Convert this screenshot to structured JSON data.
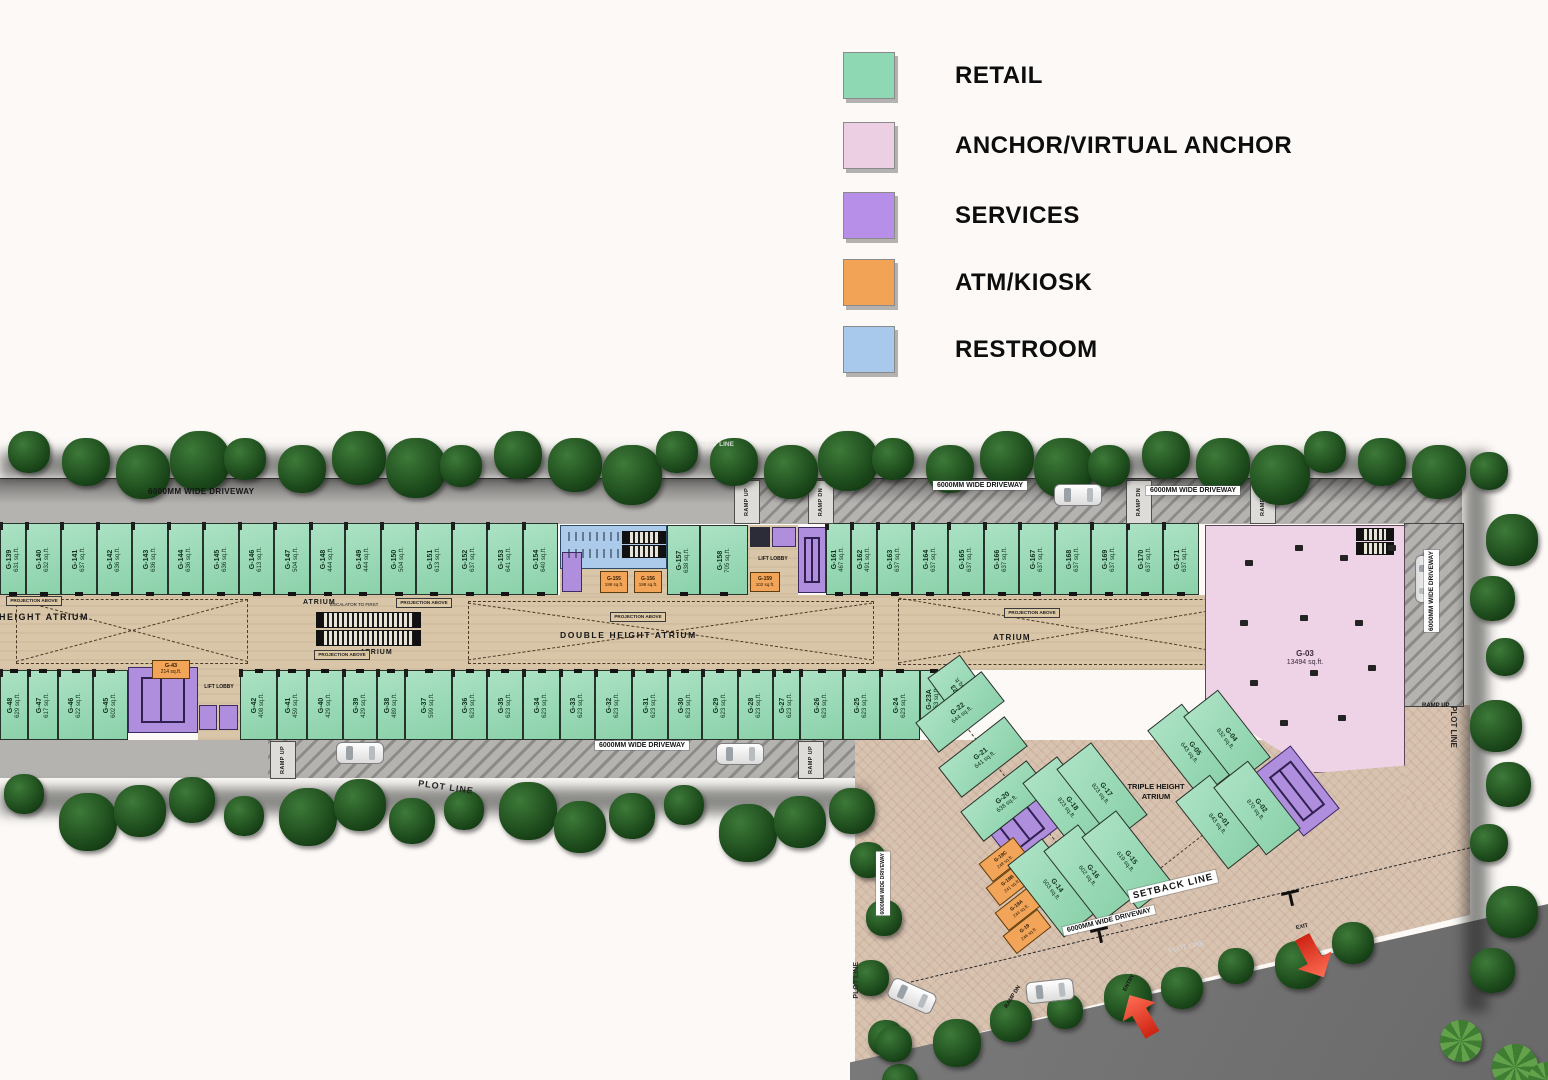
{
  "legend": {
    "items": [
      {
        "label": "RETAIL",
        "color": "#8fd8b4"
      },
      {
        "label": "ANCHOR/VIRTUAL ANCHOR",
        "color": "#eccfe3"
      },
      {
        "label": "SERVICES",
        "color": "#b78ee8"
      },
      {
        "label": "ATM/KIOSK",
        "color": "#f2a355"
      },
      {
        "label": "RESTROOM",
        "color": "#a8c8ec"
      }
    ]
  },
  "labels": {
    "driveway": "6000MM WIDE DRIVEWAY",
    "ramp_up": "RAMP UP",
    "ramp_dn": "RAMP DN",
    "plot_line": "PLOT LINE",
    "setback_line": "SETBACK LINE",
    "atrium": "ATRIUM",
    "double_atrium": "DOUBLE HEIGHT ATRIUM",
    "triple_atrium": "TRIPLE HEIGHT ATRIUM",
    "projection": "PROJECTION ABOVE",
    "escalator": "ESCALATOR TO FIRST",
    "lift_lobby": "LIFT LOBBY",
    "entry": "ENTRY",
    "exit": "EXIT"
  },
  "units": {
    "top_left": [
      {
        "id": "G-139",
        "area": "631 sq.ft.",
        "type": "retail"
      },
      {
        "id": "G-140",
        "area": "632 sq.ft.",
        "type": "retail"
      },
      {
        "id": "G-141",
        "area": "637 sq.ft.",
        "type": "retail"
      },
      {
        "id": "G-142",
        "area": "636 sq.ft.",
        "type": "retail"
      },
      {
        "id": "G-143",
        "area": "636 sq.ft.",
        "type": "retail"
      },
      {
        "id": "G-144",
        "area": "636 sq.ft.",
        "type": "retail"
      },
      {
        "id": "G-145",
        "area": "636 sq.ft.",
        "type": "retail"
      },
      {
        "id": "G-146",
        "area": "613 sq.ft.",
        "type": "retail"
      },
      {
        "id": "G-147",
        "area": "504 sq.ft.",
        "type": "retail"
      },
      {
        "id": "G-148",
        "area": "444 sq.ft.",
        "type": "retail"
      },
      {
        "id": "G-149",
        "area": "444 sq.ft.",
        "type": "retail"
      },
      {
        "id": "G-150",
        "area": "504 sq.ft.",
        "type": "retail"
      },
      {
        "id": "G-151",
        "area": "613 sq.ft.",
        "type": "retail"
      },
      {
        "id": "G-152",
        "area": "637 sq.ft.",
        "type": "retail"
      },
      {
        "id": "G-153",
        "area": "641 sq.ft.",
        "type": "retail"
      },
      {
        "id": "G-154",
        "area": "640 sq.ft.",
        "type": "retail"
      }
    ],
    "top_mid": [
      {
        "id": "G-155",
        "area": "199 sq.ft.",
        "type": "atm"
      },
      {
        "id": "G-156",
        "area": "198 sq.ft.",
        "type": "atm"
      },
      {
        "id": "G-157",
        "area": "638 sq.ft.",
        "type": "retail"
      },
      {
        "id": "G-158",
        "area": "705 sq.ft.",
        "type": "retail"
      },
      {
        "id": "G-159",
        "area": "102 sq.ft.",
        "type": "atm"
      }
    ],
    "top_right": [
      {
        "id": "G-161",
        "area": "467 sq.ft.",
        "type": "retail"
      },
      {
        "id": "G-162",
        "area": "491 sq.ft.",
        "type": "retail"
      },
      {
        "id": "G-163",
        "area": "637 sq.ft.",
        "type": "retail"
      },
      {
        "id": "G-164",
        "area": "637 sq.ft.",
        "type": "retail"
      },
      {
        "id": "G-165",
        "area": "637 sq.ft.",
        "type": "retail"
      },
      {
        "id": "G-166",
        "area": "637 sq.ft.",
        "type": "retail"
      },
      {
        "id": "G-167",
        "area": "637 sq.ft.",
        "type": "retail"
      },
      {
        "id": "G-168",
        "area": "637 sq.ft.",
        "type": "retail"
      },
      {
        "id": "G-169",
        "area": "637 sq.ft.",
        "type": "retail"
      },
      {
        "id": "G-170",
        "area": "637 sq.ft.",
        "type": "retail"
      },
      {
        "id": "G-171",
        "area": "637 sq.ft.",
        "type": "retail"
      }
    ],
    "bottom_left": [
      {
        "id": "G-48",
        "area": "629 sq.ft.",
        "type": "retail"
      },
      {
        "id": "G-47",
        "area": "617 sq.ft.",
        "type": "retail"
      },
      {
        "id": "G-46",
        "area": "622 sq.ft.",
        "type": "retail"
      },
      {
        "id": "G-45",
        "area": "602 sq.ft.",
        "type": "retail"
      }
    ],
    "atm_g43": {
      "id": "G-43",
      "area": "214 sq.ft.",
      "type": "atm"
    },
    "bottom_main": [
      {
        "id": "G-42",
        "area": "408 sq.ft.",
        "type": "retail"
      },
      {
        "id": "G-41",
        "area": "459 sq.ft.",
        "type": "retail"
      },
      {
        "id": "G-40",
        "area": "429 sq.ft.",
        "type": "retail"
      },
      {
        "id": "G-39",
        "area": "429 sq.ft.",
        "type": "retail"
      },
      {
        "id": "G-38",
        "area": "489 sq.ft.",
        "type": "retail"
      },
      {
        "id": "G-37",
        "area": "599 sq.ft.",
        "type": "retail"
      },
      {
        "id": "G-36",
        "area": "623 sq.ft.",
        "type": "retail"
      },
      {
        "id": "G-35",
        "area": "623 sq.ft.",
        "type": "retail"
      },
      {
        "id": "G-34",
        "area": "623 sq.ft.",
        "type": "retail"
      },
      {
        "id": "G-33",
        "area": "623 sq.ft.",
        "type": "retail"
      },
      {
        "id": "G-32",
        "area": "623 sq.ft.",
        "type": "retail"
      },
      {
        "id": "G-31",
        "area": "623 sq.ft.",
        "type": "retail"
      },
      {
        "id": "G-30",
        "area": "623 sq.ft.",
        "type": "retail"
      },
      {
        "id": "G-29",
        "area": "623 sq.ft.",
        "type": "retail"
      },
      {
        "id": "G-28",
        "area": "623 sq.ft.",
        "type": "retail"
      },
      {
        "id": "G-27",
        "area": "623 sq.ft.",
        "type": "retail"
      },
      {
        "id": "G-26",
        "area": "623 sq.ft.",
        "type": "retail"
      },
      {
        "id": "G-25",
        "area": "623 sq.ft.",
        "type": "retail"
      },
      {
        "id": "G-24",
        "area": "623 sq.ft.",
        "type": "retail"
      },
      {
        "id": "G-23A",
        "area": "253 sq.ft.",
        "type": "retail"
      },
      {
        "id": "G-23",
        "area": "258 sq.ft.",
        "type": "retail"
      }
    ],
    "diag_small": [
      {
        "id": "G-22",
        "area": "644 sq.ft.",
        "type": "retail"
      },
      {
        "id": "G-21",
        "area": "641 sq.ft.",
        "type": "retail"
      },
      {
        "id": "G-20",
        "area": "638 sq.ft.",
        "type": "retail"
      }
    ],
    "kiosk_stack": [
      {
        "id": "G-19C",
        "area": "248 sq.ft.",
        "type": "atm"
      },
      {
        "id": "G-19B",
        "area": "241 sq.ft.",
        "type": "atm"
      },
      {
        "id": "G-19A",
        "area": "244 sq.ft.",
        "type": "atm"
      },
      {
        "id": "G-19",
        "area": "246 sq.ft.",
        "type": "atm"
      }
    ],
    "diag_large": [
      {
        "id": "G-18",
        "area": "823 sq.ft.",
        "type": "retail"
      },
      {
        "id": "G-17",
        "area": "823 sq.ft.",
        "type": "retail"
      },
      {
        "id": "G-14",
        "area": "503 sq.ft.",
        "type": "retail"
      },
      {
        "id": "G-16",
        "area": "602 sq.ft.",
        "type": "retail"
      },
      {
        "id": "G-15",
        "area": "619 sq.ft.",
        "type": "retail"
      }
    ],
    "corner": [
      {
        "id": "G-05",
        "area": "643 sq.ft.",
        "type": "retail"
      },
      {
        "id": "G-04",
        "area": "832 sq.ft.",
        "type": "retail"
      },
      {
        "id": "G-01",
        "area": "843 sq.ft.",
        "type": "retail"
      },
      {
        "id": "G-02",
        "area": "870 sq.ft.",
        "type": "retail"
      }
    ],
    "anchor": {
      "id": "G-03",
      "area": "13494 sq.ft.",
      "type": "anchor"
    }
  }
}
